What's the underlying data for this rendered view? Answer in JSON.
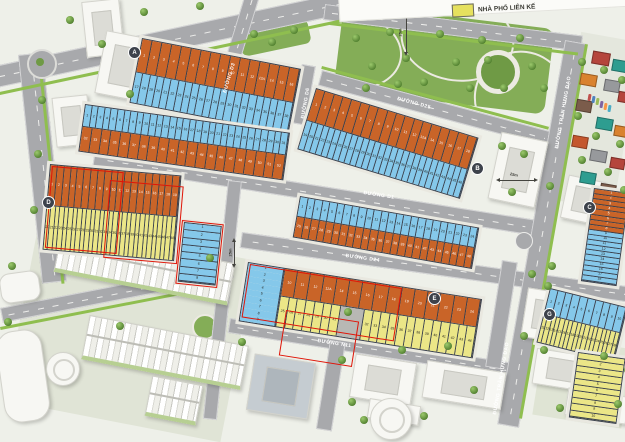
{
  "legend": {
    "items": [
      {
        "label": "NHÀ PHỐ LIÊN KẾ",
        "color": "#e6e15e"
      }
    ]
  },
  "streets": [
    {
      "name": "ĐƯỜNG D3"
    },
    {
      "name": "ĐƯỜNG D6"
    },
    {
      "name": "ĐƯỜNG D25"
    },
    {
      "name": "ĐƯỜNG D1"
    },
    {
      "name": "ĐƯỜNG D24"
    },
    {
      "name": "ĐƯỜNG N11"
    },
    {
      "name": "ĐƯỜNG TRẦN HƯNG ĐẠO"
    },
    {
      "name": "ĐƯỜNG TRẦN HƯNG ĐẠO"
    }
  ],
  "annotations": [
    {
      "label": "25m"
    },
    {
      "label": "25m"
    },
    {
      "label": "25m"
    }
  ],
  "palette": {
    "orange": "#c96428",
    "blue": "#85c8ea",
    "yellow": "#ebe687",
    "gray": "#b8b8b4",
    "plot_border": "#39404d",
    "red_outline": "#e01508",
    "road": "#a8a9ac",
    "park": "#84ad57",
    "badge": "#3d424b"
  },
  "house_colors": [
    "#b5453c",
    "#2e9d90",
    "#d9822f",
    "#97999c",
    "#7b5c4b",
    "#c4572e"
  ],
  "car_colors": [
    "#c0504d",
    "#4f81bd",
    "#9bbb59",
    "#8064a2",
    "#f79646",
    "#4bacc6"
  ],
  "blocks": {
    "A": {
      "badge": "A",
      "rows": [
        {
          "color": "orange",
          "from": 1,
          "to": 16,
          "skip13": true
        },
        {
          "color": "blue",
          "from": 17,
          "to": 38
        }
      ]
    },
    "BW": {
      "badge": "",
      "rows": [
        {
          "color": "blue",
          "from": 1,
          "to": 31
        },
        {
          "color": "orange",
          "from": 32,
          "to": 52
        }
      ]
    },
    "BE": {
      "badge": "B",
      "rows": [
        {
          "color": "orange",
          "from": 1,
          "to": 18,
          "skip13": true
        },
        {
          "color": "blue",
          "from": 19,
          "to": 46
        }
      ]
    },
    "DW": {
      "badge": "D",
      "rows": [
        {
          "color": "orange",
          "from": 1,
          "to": 19
        },
        {
          "color": "yellow",
          "from": 20,
          "to": 48
        }
      ]
    },
    "DSTACK": {
      "badge": "",
      "rows": [
        {
          "color": "blue",
          "from": 1,
          "to": 8,
          "dir": "v"
        }
      ]
    },
    "DE": {
      "badge": "",
      "rows": [
        {
          "color": "blue",
          "from": 1,
          "to": 24
        },
        {
          "color": "orange",
          "from": 25,
          "to": 48
        }
      ]
    },
    "E": {
      "badge": "E",
      "stack": {
        "color": "blue",
        "from": 1,
        "to": 9,
        "dir": "v"
      },
      "rows": [
        {
          "color": "orange",
          "from": 10,
          "to": 24,
          "skip13": true
        },
        {
          "color": "yellow",
          "from": 25,
          "to": 44,
          "gray_after": 31
        }
      ]
    },
    "G": {
      "badge": "G",
      "rows": [
        {
          "color": "blue",
          "from": 1,
          "to": 10
        },
        {
          "color": "yellow",
          "from": 11,
          "to": 28
        }
      ]
    },
    "C": {
      "badge": "C",
      "rows": [
        {
          "dir": "v",
          "segments": [
            {
              "color": "orange",
              "from": 1,
              "to": 8
            },
            {
              "color": "blue",
              "from": 9,
              "to": 18
            }
          ]
        }
      ]
    },
    "CORNER": {
      "badge": "",
      "rows": [
        {
          "color": "yellow",
          "from": 1,
          "to": 10,
          "dir": "v"
        }
      ]
    }
  }
}
